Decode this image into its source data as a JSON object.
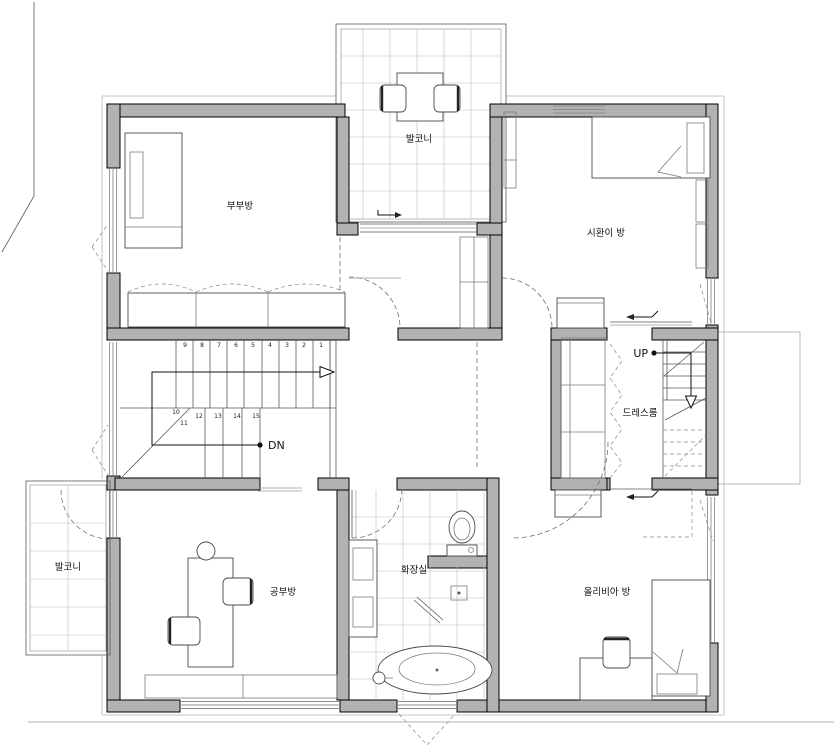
{
  "rooms": {
    "master_bedroom": {
      "label": "부부방"
    },
    "balcony_top": {
      "label": "발코니"
    },
    "sihwan_room": {
      "label": "시환이 방"
    },
    "dress_room": {
      "label": "드레스룸"
    },
    "study_room": {
      "label": "공부방"
    },
    "bathroom": {
      "label": "화장실"
    },
    "olivia_room": {
      "label": "올리비아 방"
    },
    "balcony_left": {
      "label": "발코니"
    }
  },
  "stairs": {
    "up_label": "UP",
    "down_label": "DN",
    "upper_numbers": [
      "9",
      "8",
      "7",
      "6",
      "5",
      "4",
      "3",
      "2",
      "1"
    ],
    "winder_numbers": [
      "10",
      "11"
    ],
    "lower_numbers": [
      "12",
      "13",
      "14",
      "15"
    ]
  },
  "colors": {
    "wall_fill": "#b2b2b2",
    "wall_edge": "#000000",
    "thin_line": "#5a5a5a",
    "grid_line": "#bcbcbc",
    "dashed_line": "#6f6f6f",
    "background": "#ffffff"
  }
}
